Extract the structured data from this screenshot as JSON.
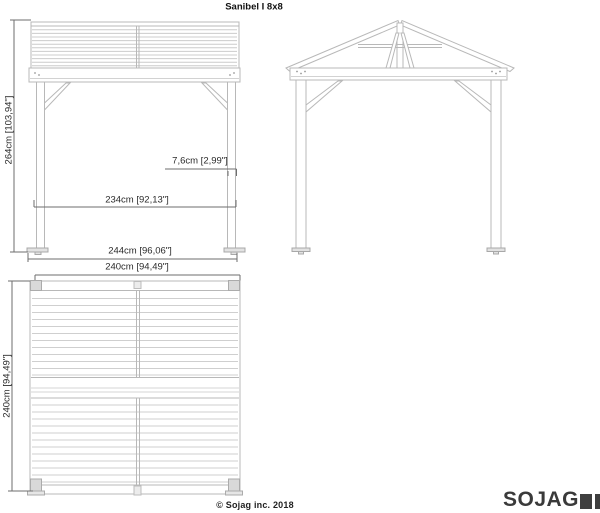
{
  "page": {
    "title": "Sanibel I 8x8",
    "copyright": "© Sojag inc. 2018"
  },
  "logo": {
    "brand": "SOJAG",
    "mark": "two-dark-squares",
    "color": "#3f3f3f"
  },
  "views": {
    "side_elevation": {
      "label": "side elevation with louvered roof panel",
      "dims": {
        "overall_height": "264cm [103,94\"]",
        "post_width": "7,6cm [2,99\"]",
        "clear_span": "234cm [92,13\"]",
        "base_width": "244cm [96,06\"]"
      }
    },
    "front_elevation": {
      "label": "front gable elevation with king-post truss"
    },
    "roof_plan": {
      "label": "roof plan (top view)",
      "dims": {
        "width": "240cm [94,49\"]",
        "depth": "240cm [94,49\"]"
      }
    }
  },
  "colors": {
    "drawing_line": "#b8b8b8",
    "slat_line": "#cccccc",
    "dimension_line": "#6e6e6e",
    "text": "#2b2b2b",
    "logo": "#3f3f3f"
  }
}
